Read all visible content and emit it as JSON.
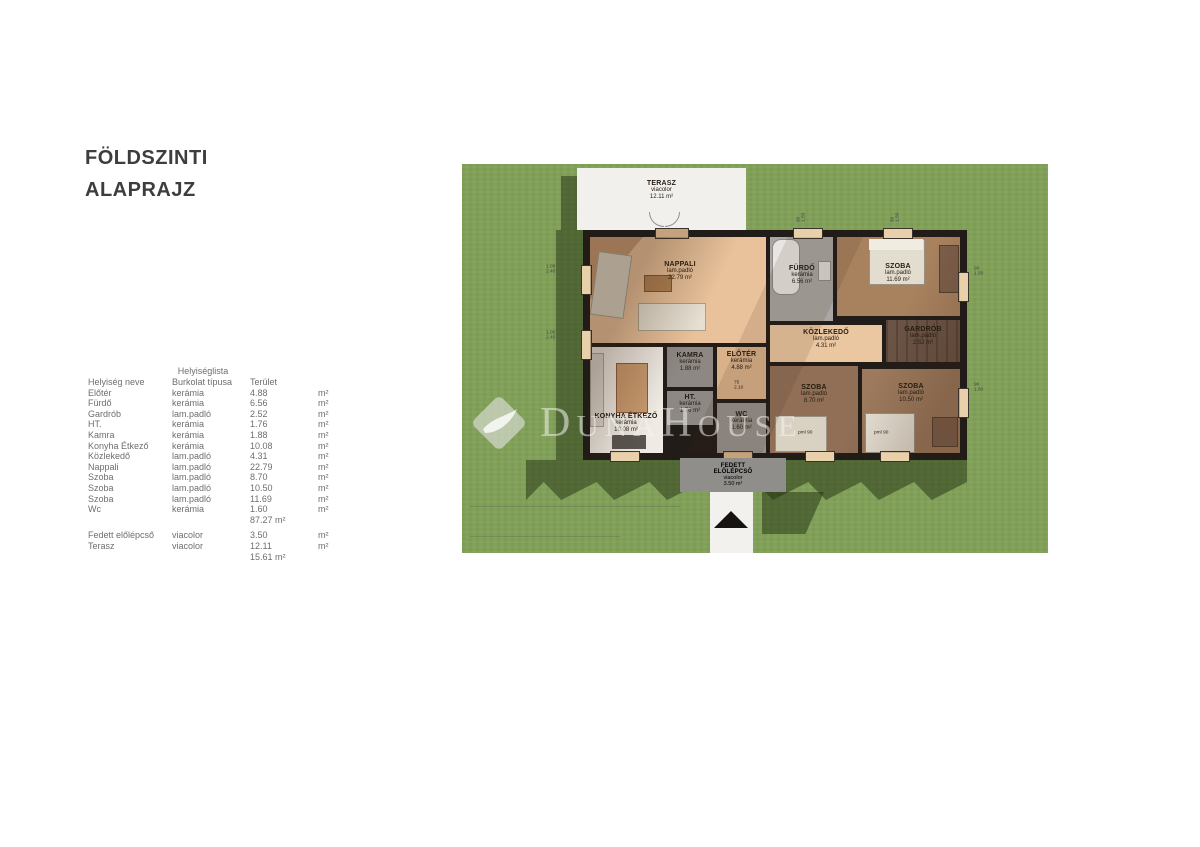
{
  "page": {
    "title_line1": "FÖLDSZINTI",
    "title_line2": "ALAPRAJZ"
  },
  "table": {
    "title": "Helyiséglista",
    "headers": {
      "name": "Helyiség neve",
      "type": "Burkolat típusa",
      "area": "Terület"
    },
    "rows": [
      {
        "name": "Előtér",
        "type": "kerámia",
        "area": "4.88",
        "unit": "m²"
      },
      {
        "name": "Fürdő",
        "type": "kerámia",
        "area": "6.56",
        "unit": "m²"
      },
      {
        "name": "Gardrób",
        "type": "lam.padló",
        "area": "2.52",
        "unit": "m²"
      },
      {
        "name": "HT.",
        "type": "kerámia",
        "area": "1.76",
        "unit": "m²"
      },
      {
        "name": "Kamra",
        "type": "kerámia",
        "area": "1.88",
        "unit": "m²"
      },
      {
        "name": "Konyha Étkező",
        "type": "kerámia",
        "area": "10.08",
        "unit": "m²"
      },
      {
        "name": "Közlekedő",
        "type": "lam.padló",
        "area": "4.31",
        "unit": "m²"
      },
      {
        "name": "Nappali",
        "type": "lam.padló",
        "area": "22.79",
        "unit": "m²"
      },
      {
        "name": "Szoba",
        "type": "lam.padló",
        "area": "8.70",
        "unit": "m²"
      },
      {
        "name": "Szoba",
        "type": "lam.padló",
        "area": "10.50",
        "unit": "m²"
      },
      {
        "name": "Szoba",
        "type": "lam.padló",
        "area": "11.69",
        "unit": "m²"
      },
      {
        "name": "Wc",
        "type": "kerámia",
        "area": "1.60",
        "unit": "m²"
      }
    ],
    "subtotal_main": "87.27 m²",
    "extra_rows": [
      {
        "name": "Fedett előlépcső",
        "type": "viacolor",
        "area": "3.50",
        "unit": "m²"
      },
      {
        "name": "Terasz",
        "type": "viacolor",
        "area": "12.11",
        "unit": "m²"
      }
    ],
    "subtotal_extra": "15.61 m²"
  },
  "plan": {
    "watermark": {
      "d": "D",
      "una": "UNA",
      "h": "H",
      "ouse": "OUSE"
    },
    "rooms": {
      "terasz": {
        "name": "TERASZ",
        "floor": "viacolor",
        "area": "12.11 m²"
      },
      "nappali": {
        "name": "NAPPALI",
        "floor": "lam.padló",
        "area": "22.79 m²"
      },
      "furdo": {
        "name": "FÜRDŐ",
        "floor": "kerámia",
        "area": "6.56 m²"
      },
      "szoba_felso": {
        "name": "SZOBA",
        "floor": "lam.padló",
        "area": "11.69 m²"
      },
      "kozlekedo": {
        "name": "KÖZLEKEDŐ",
        "floor": "lam.padló",
        "area": "4.31 m²"
      },
      "gardrob": {
        "name": "GARDRÓB",
        "floor": "lam.padló",
        "area": "2.52 m²"
      },
      "konyha": {
        "name": "KONYHA ÉTKEZŐ",
        "floor": "kerámia",
        "area": "10.08 m²"
      },
      "kamra": {
        "name": "KAMRA",
        "floor": "kerámia",
        "area": "1.88 m²"
      },
      "ht": {
        "name": "HT.",
        "floor": "kerámia",
        "area": "1.76 m²"
      },
      "eloter": {
        "name": "ELŐTÉR",
        "floor": "kerámia",
        "area": "4.88 m²"
      },
      "wc": {
        "name": "WC",
        "floor": "kerámia",
        "area": "1.60 m²"
      },
      "szoba_kozep": {
        "name": "SZOBA",
        "floor": "lam.padló",
        "area": "8.70 m²"
      },
      "szoba_jobb": {
        "name": "SZOBA",
        "floor": "lam.padló",
        "area": "10.50 m²"
      },
      "elolepcso": {
        "name": "FEDETT ELŐLÉPCSŐ",
        "floor": "viacolor",
        "area": "3.50 m²"
      }
    },
    "dims": [
      {
        "t": "90\n1.50"
      },
      {
        "t": "90\n1.50"
      },
      {
        "t": "1.00\n2.40"
      },
      {
        "t": "1.00\n2.40"
      },
      {
        "t": "90\n1.50"
      },
      {
        "t": "90\n1.50"
      },
      {
        "t": "pml 90"
      },
      {
        "t": "pml 90"
      },
      {
        "t": "75\n2.10"
      }
    ]
  },
  "colors": {
    "grass": "#81a058",
    "grass_shadow": "#3b4f26",
    "wall": "#221c18",
    "wood_light": "#e9c29b",
    "wood_dark": "#916f57",
    "tile_gray": "#a9a6a3",
    "terrace_white": "#f2f0ed",
    "watermark": "#f4f4f2"
  }
}
